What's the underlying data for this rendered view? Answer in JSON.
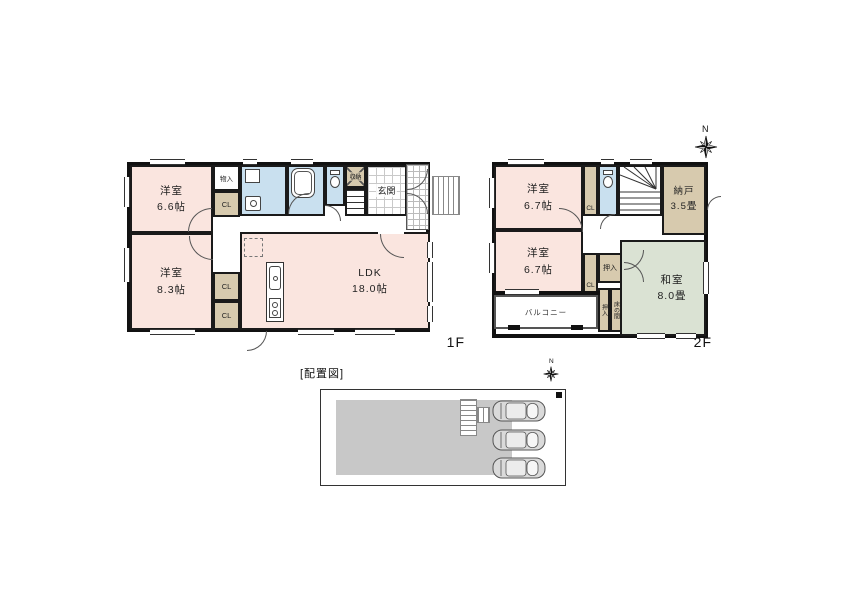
{
  "compass": {
    "north": "N"
  },
  "floor1": {
    "label": "1F",
    "rooms": {
      "yoshitsu_a": {
        "name": "洋室",
        "size": "6.6帖"
      },
      "yoshitsu_b": {
        "name": "洋室",
        "size": "8.3帖"
      },
      "ldk": {
        "name": "LDK",
        "size": "18.0帖"
      },
      "monoire": {
        "label": "物入"
      },
      "cl_a": {
        "label": "CL"
      },
      "cl_b": {
        "label": "CL"
      },
      "cl_c": {
        "label": "CL"
      },
      "shunou": {
        "label": "収納"
      },
      "genkan": {
        "label": "玄関"
      }
    }
  },
  "floor2": {
    "label": "2F",
    "rooms": {
      "yoshitsu_a": {
        "name": "洋室",
        "size": "6.7帖"
      },
      "yoshitsu_b": {
        "name": "洋室",
        "size": "6.7帖"
      },
      "washitsu": {
        "name": "和室",
        "size": "8.0畳"
      },
      "nando": {
        "name": "納戸",
        "size": "3.5畳"
      },
      "cl_a": {
        "label": "CL"
      },
      "cl_b": {
        "label": "CL"
      },
      "oshiire": {
        "label": "押入"
      },
      "oshiire_b": {
        "label": "押入"
      },
      "tokonoma": {
        "label": "床の間"
      },
      "balcony": {
        "label": "バルコニー"
      }
    }
  },
  "site_plan": {
    "title": "[配置図]",
    "compass": "N",
    "car_count": 3
  },
  "colors": {
    "wall": "#1a1a1a",
    "room_pink": "#FAE5DF",
    "wet_blue": "#C9E0EF",
    "closet_tan": "#D7CAAE",
    "tatami_green": "#DAE2D3",
    "building_gray": "#C8C8C8"
  },
  "icons": [
    "compass-rose-icon",
    "toilet-icon",
    "bathtub-icon",
    "washbasin-icon",
    "washing-machine-icon",
    "kitchen-sink-icon",
    "stove-icon",
    "refrigerator-icon",
    "stairs-icon",
    "car-top-view-icon"
  ]
}
